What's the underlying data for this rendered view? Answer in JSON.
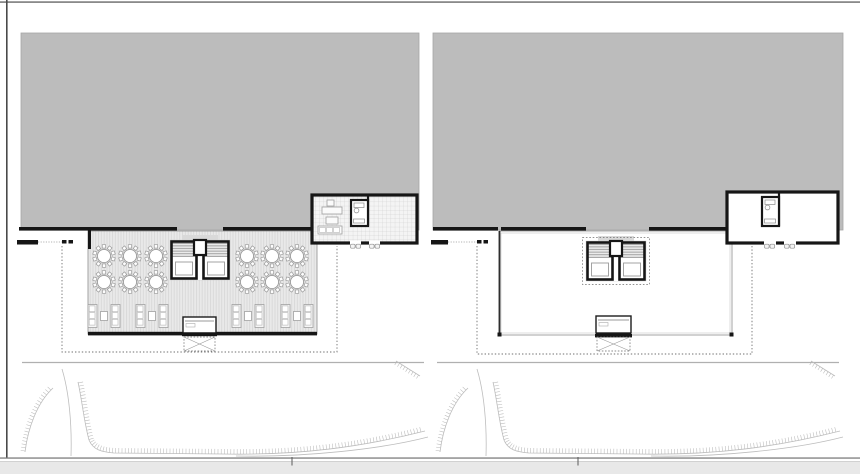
{
  "document": {
    "kind": "architectural floor plan drawing, two side-by-side plan panels (furnished banquet terrace level, and empty deck level)",
    "visible_text": [],
    "background": "#ffffff"
  },
  "colors": {
    "roof_gray": "#bcbcbc",
    "roof_edge": "#a6a6a6",
    "deck_fill": "#e9e9e9",
    "deck_hatch_line": "#d3d3d3",
    "tile_fill": "#f4f4f4",
    "tile_line": "#c9c9c9",
    "wall_black": "#161616",
    "line_gray": "#9a9a9a",
    "light_gray": "#b8b8b8",
    "dash_gray": "#6f6f6f",
    "band_gray": "#e8e8e8",
    "frame_dark": "#4a4a4a",
    "frame_mid": "#8a8a8a",
    "tread_line": "#8f8f8f",
    "tread_bg": "#ebebeb",
    "backdrop_gray": "#d9d9d9",
    "furniture_stroke": "#a0a0a0",
    "furniture_fill": "#f6f6f6"
  },
  "chrome": {
    "top_line": {
      "x": 0,
      "y": 1.2,
      "w": 860,
      "h": 1.8
    },
    "left_line": {
      "x": 6,
      "y": 0,
      "w": 1.6,
      "h": 458
    },
    "baseline": {
      "x": 0,
      "y": 457.4,
      "w": 860,
      "h": 1.3
    },
    "baseline_ticks": [
      {
        "x": 291.5,
        "y": 457,
        "w": 1,
        "h": 8.5
      },
      {
        "x": 577.5,
        "y": 457,
        "w": 1,
        "h": 8.5
      }
    ],
    "bottom_band": {
      "x": 0,
      "y": 461,
      "w": 860,
      "h": 13
    }
  },
  "stair_spec": {
    "w": 60,
    "h": 40,
    "backdrop": [
      12,
      -5,
      36,
      11
    ],
    "tread_area": [
      2,
      2,
      56,
      15
    ],
    "left_frame": [
      1.5,
      1.5,
      25,
      37
    ],
    "right_frame": [
      33.5,
      1.5,
      25,
      37
    ],
    "left_landing": [
      5.5,
      22,
      17,
      13
    ],
    "right_landing": [
      37.5,
      22,
      17,
      13
    ],
    "center_gap": [
      26.5,
      15,
      7,
      25
    ],
    "center_notch": [
      24,
      0,
      12,
      15
    ],
    "dashed_outline": [
      -3.5,
      -3.5,
      67,
      47
    ]
  },
  "table_spec": {
    "radius": 6.6,
    "chair_size": 3.4,
    "chair_radius": 9.6,
    "chair_count": 10
  },
  "lounge_spec": {
    "sofa_w": 9,
    "sofa_h": 23,
    "sofa_dx": 16,
    "cushions": 3,
    "table_w": 7,
    "table_h": 9
  },
  "terrain": {
    "boundary": {
      "x1": 22,
      "x2": 424,
      "y": 362.5
    },
    "paths": [
      {
        "name": "embankment-arc-left",
        "d": "M25,452 C28,428 37,403 53,388",
        "hatch": true,
        "side": -1,
        "tick": 4.5
      },
      {
        "name": "contour-line-left",
        "d": "M62,369 C69,392 72,424 71,456",
        "hatch": false
      },
      {
        "name": "embankment-main",
        "d": "M78,382 C82,400 84,422 89,440 C93,450 102,452 114,453 L222,454 C300,455.5 362,447 425,431",
        "hatch": true,
        "side": -1,
        "tick": 5
      },
      {
        "name": "contour-line-bottom",
        "d": "M236,456 C305,457.5 382,449 428,437",
        "hatch": false
      },
      {
        "name": "embankment-corner",
        "d": "M396,361 L420,376",
        "hatch": true,
        "side": 1,
        "tick": 4
      }
    ]
  },
  "panels": [
    {
      "id": "left",
      "roof": {
        "x": 21,
        "y": 33,
        "w": 398,
        "h": 197
      },
      "wall_y": 227,
      "wall_h": 3.6,
      "wall_segments": [
        [
          19,
          177
        ],
        [
          223,
          313
        ]
      ],
      "wall_stubs": [
        {
          "x": 88,
          "y": 230,
          "w": 3,
          "h": 19
        }
      ],
      "ledge": {
        "x": 17,
        "y": 240,
        "w": 21,
        "h": 4.5
      },
      "ledge_dotted": {
        "x1": 38,
        "x2": 62,
        "y": 242
      },
      "dot_marks": [
        [
          62,
          240
        ],
        [
          68.5,
          240
        ]
      ],
      "dotted_boundary": {
        "x1": 62,
        "y1": 246,
        "x2": 337,
        "y2": 352
      },
      "deck": {
        "x": 88,
        "y": 231,
        "w": 229,
        "h": 103,
        "hatched": true,
        "dark_left_edge": false,
        "bottom_bar": [
          88,
          317
        ],
        "corner_marks": false
      },
      "stair": {
        "x": 170,
        "y": 240,
        "dashed": false
      },
      "stage": {
        "x": 183,
        "y": 317,
        "w": 33,
        "h": 16,
        "bar": [
          182,
          332.4,
          35,
          3.8
        ]
      },
      "xbox": {
        "x": 184,
        "y": 337,
        "w": 31,
        "h": 14
      },
      "tables": [
        [
          104,
          256
        ],
        [
          130,
          256
        ],
        [
          156,
          256
        ],
        [
          104,
          282
        ],
        [
          130,
          282
        ],
        [
          156,
          282
        ],
        [
          247,
          256
        ],
        [
          272,
          256
        ],
        [
          297,
          256
        ],
        [
          247,
          282
        ],
        [
          272,
          282
        ],
        [
          297,
          282
        ]
      ],
      "lounges": [
        [
          104,
          316
        ],
        [
          152,
          316
        ],
        [
          248,
          316
        ],
        [
          297,
          316
        ]
      ],
      "room": {
        "x": 312,
        "y": 195,
        "w": 105,
        "h": 48,
        "furnished": true,
        "wc": {
          "x": 351,
          "y": 200,
          "w": 17,
          "h": 26
        },
        "divider_x": 368,
        "doors": [
          [
            350,
            361
          ],
          [
            369,
            380
          ]
        ],
        "furniture": {
          "chair": [
            327,
            200,
            7,
            6
          ],
          "desk": [
            322,
            207,
            20,
            7
          ],
          "side_table": [
            326,
            217,
            12,
            7
          ],
          "sofa": [
            318,
            226,
            24,
            8
          ]
        }
      },
      "terrain_dx": 0
    },
    {
      "id": "right",
      "roof": {
        "x": 433,
        "y": 33,
        "w": 410,
        "h": 197
      },
      "wall_y": 227,
      "wall_h": 3.6,
      "wall_segments": [
        [
          433,
          498
        ],
        [
          501,
          586
        ],
        [
          649,
          729
        ]
      ],
      "wall_stubs": [],
      "ledge": {
        "x": 431,
        "y": 240,
        "w": 17,
        "h": 4.5
      },
      "ledge_dotted": {
        "x1": 448,
        "x2": 477,
        "y": 242
      },
      "dot_marks": [
        [
          477,
          240
        ],
        [
          483.5,
          240
        ]
      ],
      "dotted_boundary": {
        "x1": 477,
        "y1": 246,
        "x2": 752,
        "y2": 354
      },
      "deck": {
        "x": 499,
        "y": 231,
        "w": 233,
        "h": 104,
        "hatched": false,
        "dark_left_edge": true,
        "bottom_bar": [
          596,
          631
        ],
        "corner_marks": true
      },
      "stair": {
        "x": 586,
        "y": 241,
        "dashed": true
      },
      "stage": {
        "x": 596,
        "y": 316,
        "w": 35,
        "h": 17,
        "bar": [
          595,
          334,
          37,
          3.4
        ]
      },
      "xbox": {
        "x": 597,
        "y": 337,
        "w": 33,
        "h": 14
      },
      "tables": [],
      "lounges": [],
      "room": {
        "x": 727,
        "y": 192,
        "w": 111,
        "h": 51,
        "furnished": false,
        "wc": {
          "x": 762,
          "y": 197,
          "w": 17,
          "h": 29
        },
        "divider_x": 779,
        "doors": [
          [
            764,
            776
          ],
          [
            784,
            796
          ]
        ]
      },
      "terrain_dx": 415
    }
  ]
}
